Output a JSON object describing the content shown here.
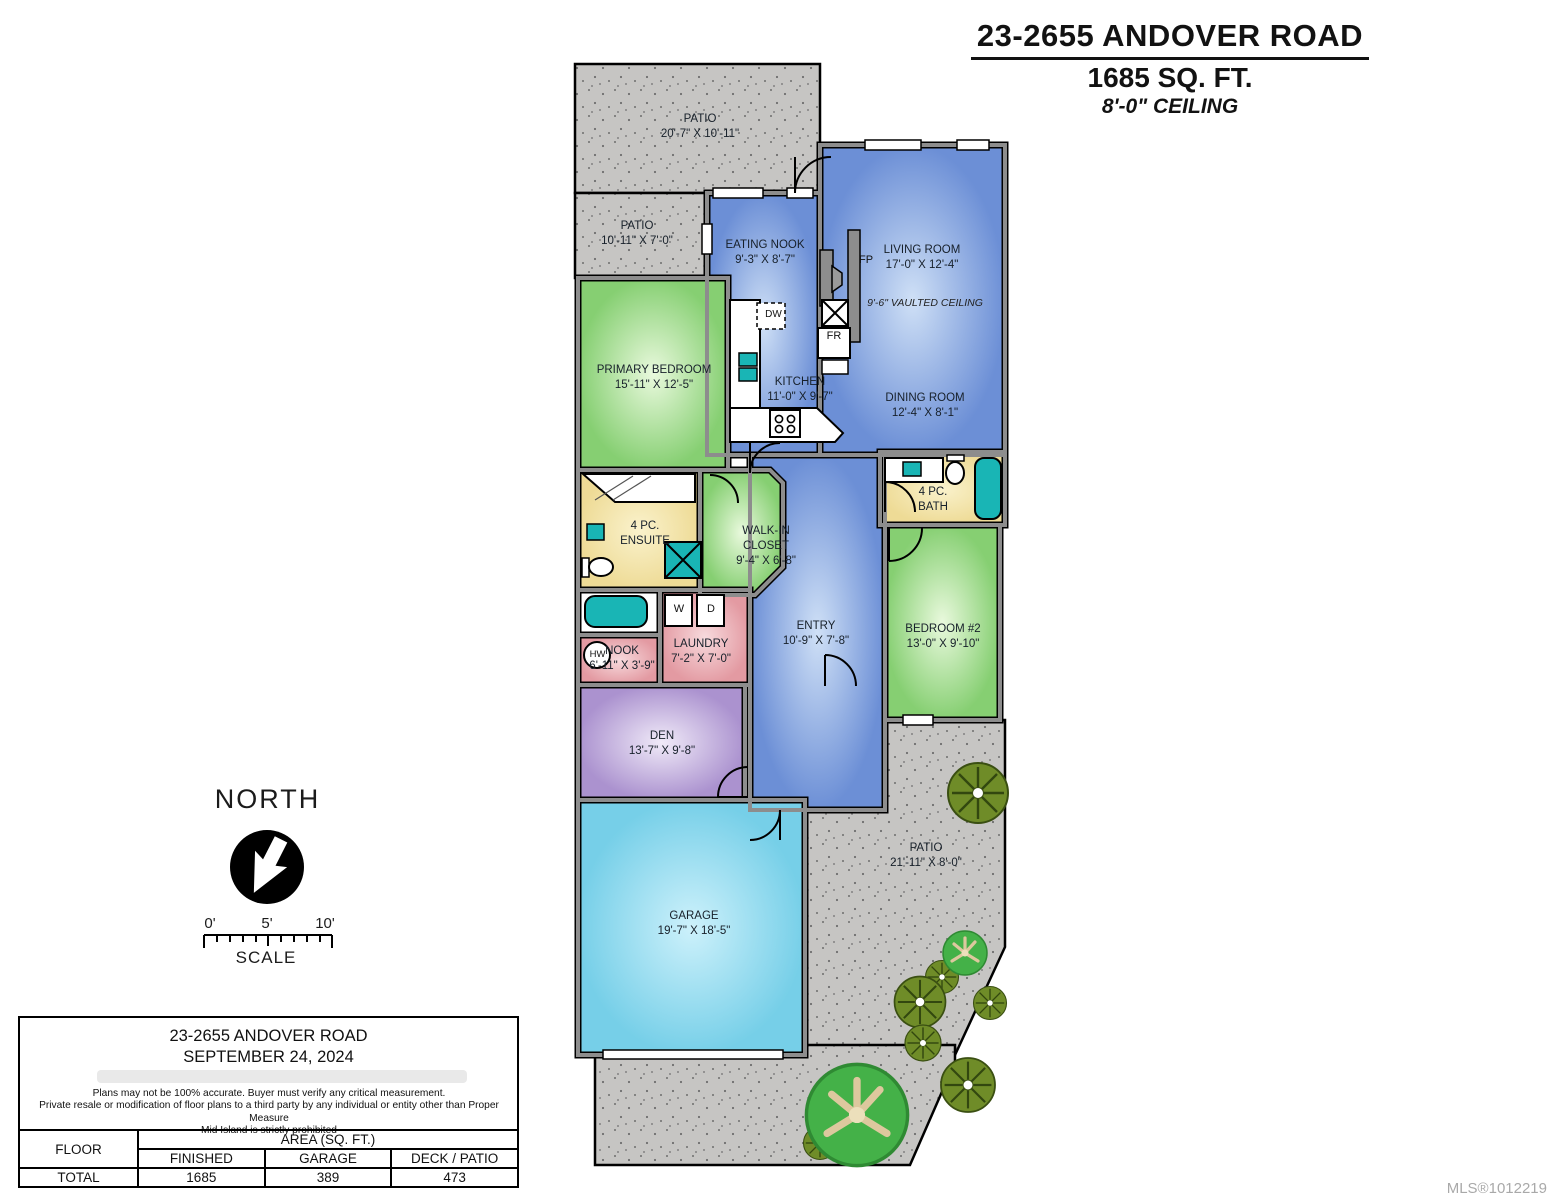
{
  "header": {
    "address": "23-2655 ANDOVER ROAD",
    "area": "1685 SQ. FT.",
    "ceiling": "8'-0\" CEILING"
  },
  "compass": {
    "north_label": "NORTH",
    "scale_label": "SCALE",
    "ticks": [
      "0'",
      "5'",
      "10'"
    ]
  },
  "plan": {
    "rooms": {
      "patio_top": {
        "l1": "PATIO",
        "l2": "20'-7\" X 10'-11\""
      },
      "patio_left": {
        "l1": "PATIO",
        "l2": "10'-11\" X 7'-0\""
      },
      "eating_nook": {
        "l1": "EATING NOOK",
        "l2": "9'-3\" X 8'-7\""
      },
      "living": {
        "l1": "LIVING ROOM",
        "l2": "17'-0\" X 12'-4\""
      },
      "kitchen": {
        "l1": "KITCHEN",
        "l2": "11'-0\" X 9'-7\""
      },
      "dining": {
        "l1": "DINING ROOM",
        "l2": "12'-4\" X 8'-1\""
      },
      "primary": {
        "l1": "PRIMARY BEDROOM",
        "l2": "15'-11\" X 12'-5\""
      },
      "ensuite": {
        "l1": "4 PC.",
        "l2": "ENSUITE"
      },
      "wic": {
        "l1": "WALK-IN",
        "l2": "CLOSET",
        "l3": "9'-4\" X 6'-8\""
      },
      "bath": {
        "l1": "4 PC.",
        "l2": "BATH"
      },
      "entry": {
        "l1": "ENTRY",
        "l2": "10'-9\" X 7'-8\""
      },
      "bedroom2": {
        "l1": "BEDROOM #2",
        "l2": "13'-0\" X 9'-10\""
      },
      "laundry": {
        "l1": "LAUNDRY",
        "l2": "7'-2\" X 7'-0\""
      },
      "nook": {
        "l1": "NOOK",
        "l2": "6'-11\" X 3'-9\""
      },
      "den": {
        "l1": "DEN",
        "l2": "13'-7\" X 9'-8\""
      },
      "garage": {
        "l1": "GARAGE",
        "l2": "19'-7\" X 18'-5\""
      },
      "patio_right": {
        "l1": "PATIO",
        "l2": "21'-11\" X 8'-0\""
      }
    },
    "labels": {
      "vaulted": "9'-6\" VAULTED CEILING",
      "fp": "FP",
      "fr": "FR",
      "dw": "DW",
      "w": "W",
      "d": "D",
      "hw": "HW"
    },
    "colors": {
      "blue_room": "#6c8fd6",
      "green_room": "#86cf72",
      "yellow_room": "#eedb96",
      "pink_room": "#e39aa2",
      "purple_room": "#ab92cf",
      "cyan_room": "#76cfe8",
      "patio_gray": "#c6c5c3",
      "fixture_teal": "#19b5b5"
    }
  },
  "footer": {
    "address": "23-2655 ANDOVER ROAD",
    "date": "SEPTEMBER 24, 2024",
    "disclaimer1": "Plans may not be 100% accurate.  Buyer must verify any critical measurement.",
    "disclaimer2": "Private resale  or modification of floor plans to a third party by any individual or entity other than Proper Measure",
    "disclaimer3": "Mid Island is strictly prohibited",
    "table": {
      "floor_header": "FLOOR",
      "area_header": "AREA (SQ. FT.)",
      "columns": [
        "FINISHED",
        "GARAGE",
        "DECK / PATIO"
      ],
      "row_label": "TOTAL",
      "values": [
        "1685",
        "389",
        "473"
      ]
    }
  },
  "watermark": "MLS®1012219"
}
